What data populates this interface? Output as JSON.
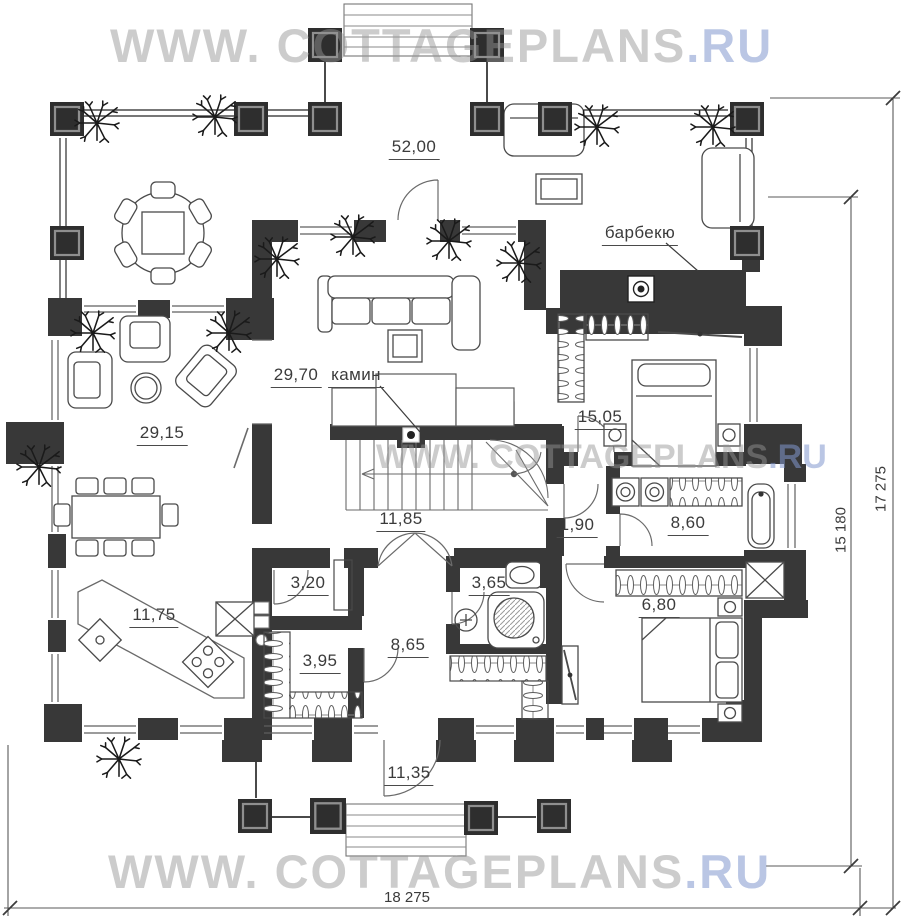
{
  "watermark": {
    "prefix": "WWW. COTTAGEPLANS",
    "suffix": ".RU"
  },
  "room_areas": {
    "terrace": "52,00",
    "living_room": "29,70",
    "sitting_room": "29,15",
    "bedroom_1": "15,05",
    "hall": "11,85",
    "corridor": "1,90",
    "bathroom_1": "8,60",
    "pantry": "3,20",
    "bathroom_2": "3,65",
    "bedroom_2": "6,80",
    "kitchen_dining": "11,75",
    "wardrobe_room": "3,95",
    "entry_hall": "8,65",
    "porch": "11,35"
  },
  "feature_labels": {
    "fireplace": "камин",
    "barbecue": "барбекю"
  },
  "dimensions": {
    "side_inner": "15 180",
    "side_outer": "17 275",
    "bottom": "18 275"
  },
  "colors": {
    "walls": "#383838",
    "drawing_lines": "#5a5a5a",
    "watermark_gray": "#949494",
    "watermark_blue": "#8298cd"
  }
}
